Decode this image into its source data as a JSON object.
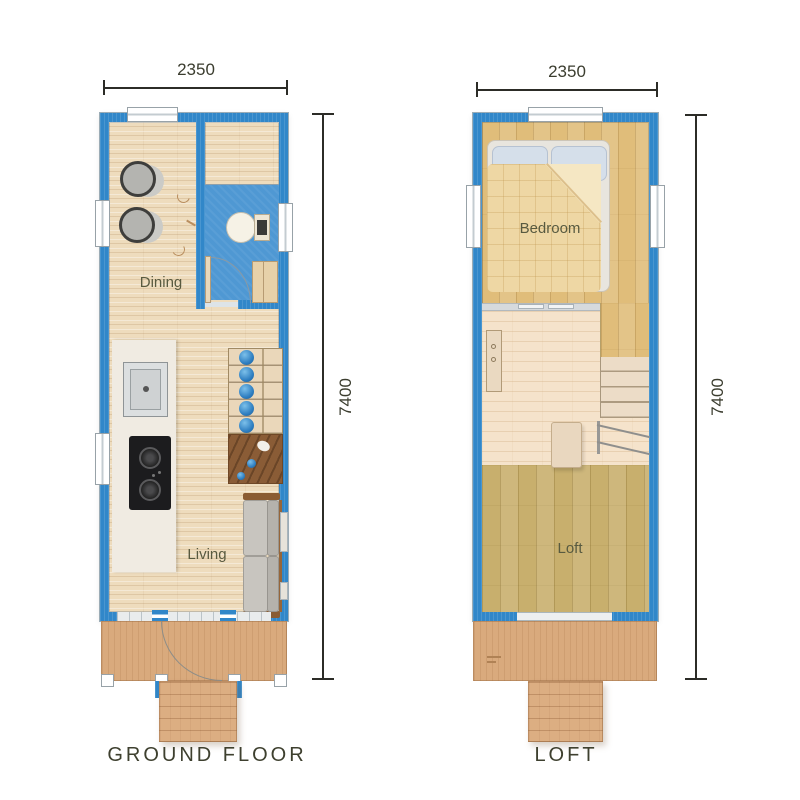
{
  "colors": {
    "wall": "#3187c9",
    "bathFloor": "#4f98d3",
    "woodLight": "#eedcbd",
    "woodHoney": "#e0bd7a",
    "woodOlive": "#c8af6d",
    "woodLanding": "#f5e3cb",
    "deck": "#d9aa7d",
    "steps": "#dcae82",
    "counter": "#f0ebe2",
    "understair": "#8a5c36",
    "stairDot": "#2d7dc0",
    "bedDuvet": "#eed7a4",
    "pillow": "#d5dfea",
    "windowFrame": "#98a2a8",
    "dimLine": "#2c2c27",
    "dimText": "#3b3d2f",
    "roomLabel": "#585a40",
    "titleText": "#3e402f"
  },
  "ground": {
    "title": "GROUND FLOOR",
    "width_label": "2350",
    "height_label": "7400",
    "labels": {
      "dining": "Dining",
      "living": "Living"
    }
  },
  "loft": {
    "title": "LOFT",
    "width_label": "2350",
    "height_label": "7400",
    "labels": {
      "bedroom": "Bedroom",
      "loft": "Loft"
    }
  }
}
